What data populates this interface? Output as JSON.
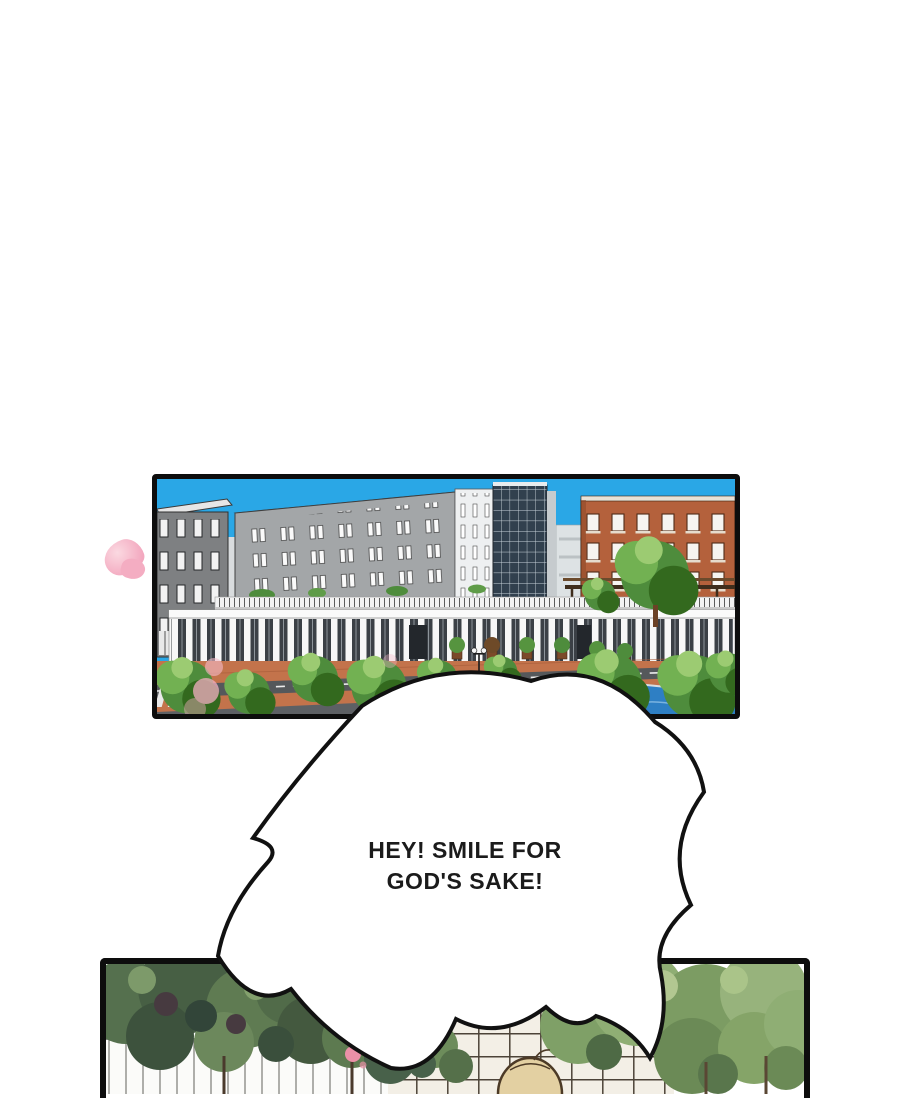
{
  "bubble": {
    "line1": "HEY! SMILE FOR",
    "line2": "GOD'S SAKE!"
  },
  "colors": {
    "page_background": "#ffffff",
    "panel_border": "#0d0d0d",
    "sky": "#2aa7e6",
    "brick_building": "#b4613c",
    "office_gray": "#a3a6a8",
    "canal_water": "#2e7fc4",
    "plaza_brick": "#c3734b",
    "tree_green": "#4e8c3c",
    "petal_pink": "#f3a8bf",
    "bubble_fill": "#ffffff",
    "bubble_outline": "#111111",
    "hair_blond": "#e3d0a2"
  }
}
